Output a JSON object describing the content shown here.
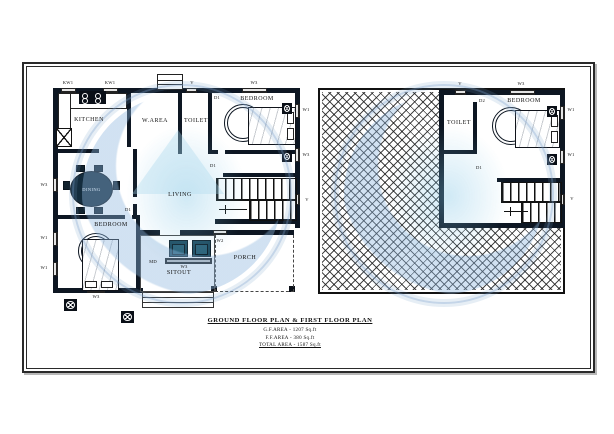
{
  "title_block": {
    "heading": "GROUND FLOOR PLAN & FIRST FLOOR PLAN",
    "gf_area": "G.F.AREA - 1207 Sq.ft",
    "ff_area": "F.F.AREA - 380 Sq.ft",
    "total_area": "TOTAL AREA - 1587 Sq.ft"
  },
  "colors": {
    "wall": "#0d1622",
    "furniture_teal": "#1c4a5e",
    "dining_table": "#142c3d",
    "watermark_blue": "#9cc0e0",
    "hatch_line": "#191919",
    "paper": "#ffffff"
  },
  "gf": {
    "rooms": {
      "kitchen": "KITCHEN",
      "warea": "W.AREA",
      "toilet": "TOILET",
      "bedroom1": "BEDROOM",
      "dining": "DINING",
      "living": "LIVING",
      "bedroom2": "BEDROOM",
      "sitout": "SITOUT",
      "porch": "PORCH"
    },
    "tags": {
      "kw1_a": "KW1",
      "kw1_b": "KW1",
      "gd": "GD",
      "v_top": "V",
      "w3_top": "W3",
      "d1_bed1": "D1",
      "w1_right": "W1",
      "w3_right": "W3",
      "d1_stair": "D1",
      "v_right": "V",
      "w3_left": "W3",
      "d1_bed2": "D1",
      "w1_left_a": "W1",
      "w1_left_b": "W1",
      "w2": "W2",
      "md": "MD",
      "w3_sitout": "W3",
      "w3_bottom": "W3"
    }
  },
  "ff": {
    "rooms": {
      "toilet": "TOILET",
      "bedroom": "BEDROOM"
    },
    "tags": {
      "v_top": "V",
      "w3_top": "W3",
      "d2": "D2",
      "w1_a": "W1",
      "w1_b": "W1",
      "d1": "D1",
      "v_right": "V"
    }
  }
}
